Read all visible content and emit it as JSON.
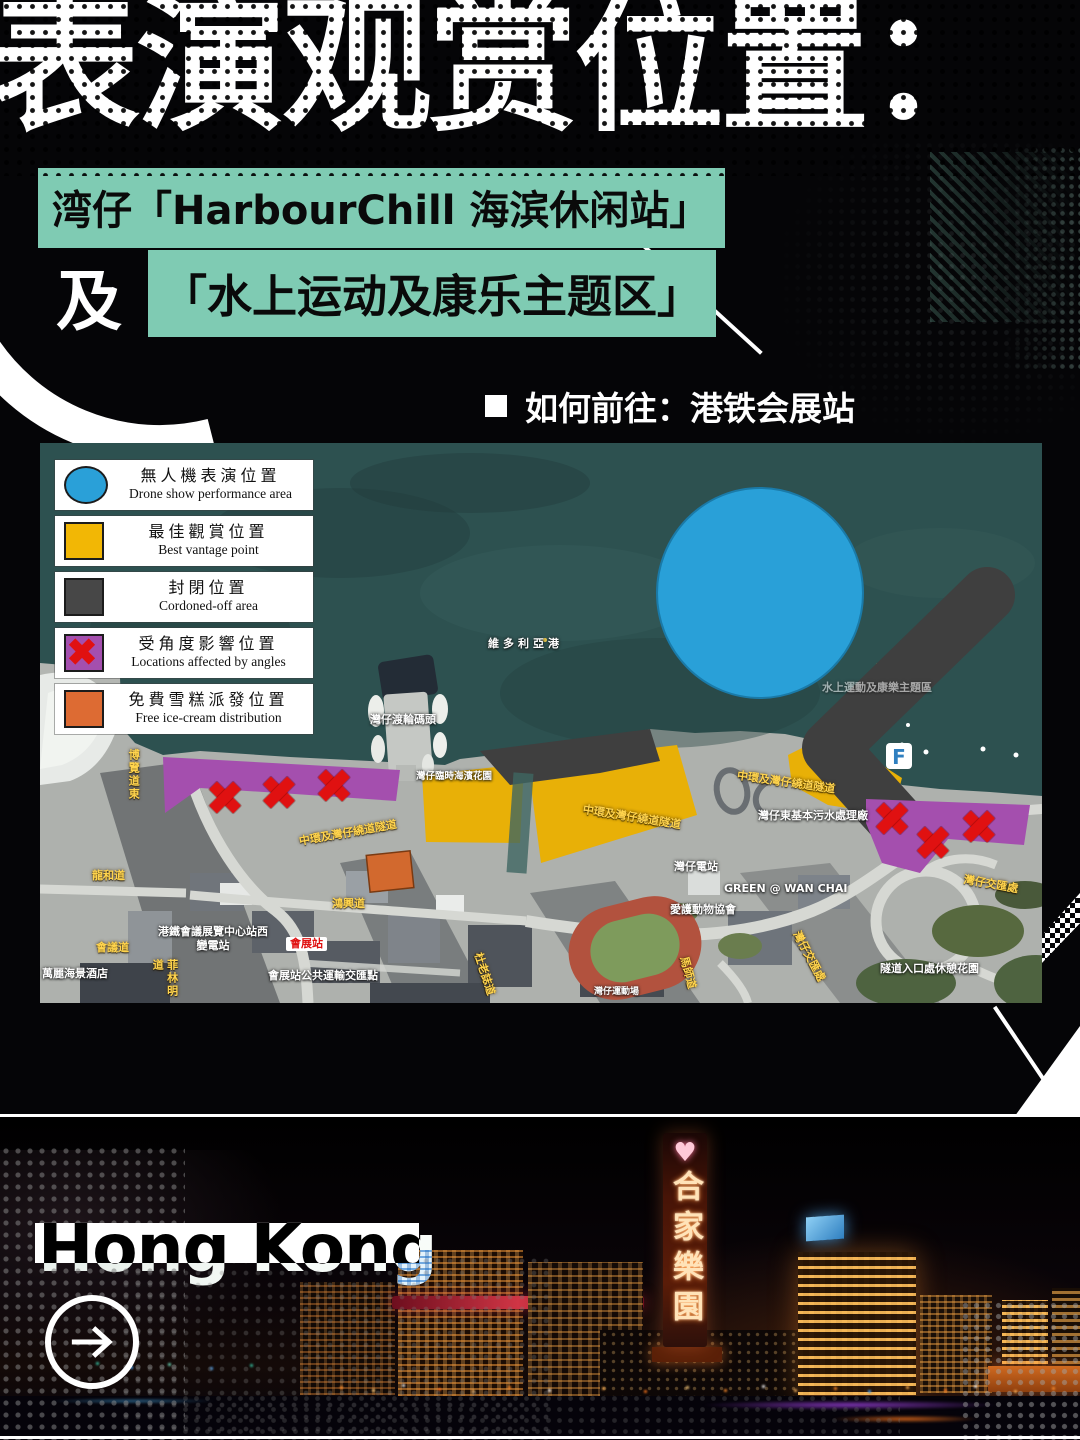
{
  "header": {
    "title": "表演观赏位置：",
    "venue_line1": "湾仔「HarbourChill 海滨休闲站」",
    "conjunction": "及",
    "venue_line2": "「水上运动及康乐主题区」",
    "directions_text": "如何前往：港铁会展站"
  },
  "colors": {
    "accent_teal": "#7fcbb3",
    "title_white": "#ffffff"
  },
  "legend": {
    "items": [
      {
        "name": "drone-show-area",
        "shape": "circle",
        "color": "#2aa0d8",
        "zh": "無人機表演位置",
        "en": "Drone show performance area"
      },
      {
        "name": "best-vantage",
        "shape": "square",
        "color": "#f2b705",
        "zh": "最佳觀賞位置",
        "en": "Best vantage point"
      },
      {
        "name": "cordoned-off",
        "shape": "square",
        "color": "#474747",
        "zh": "封閉位置",
        "en": "Cordoned-off area"
      },
      {
        "name": "affected-by-angles",
        "shape": "square-x",
        "color": "#a44fae",
        "x_color": "#e01111",
        "zh": "受角度影響位置",
        "en": "Locations affected by angles"
      },
      {
        "name": "free-ice-cream",
        "shape": "square",
        "color": "#dd6b33",
        "zh": "免費雪糕派發位置",
        "en": "Free ice-cream distribution"
      }
    ]
  },
  "map": {
    "colors": {
      "water": "#2d5150",
      "land": "#b3b6b2",
      "drone": "#29a0d8",
      "drone_edge": "#1a7aa8",
      "vantage": "#e8b007",
      "cordoned": "#3f3f3f",
      "angles": "#a44fae",
      "x_mark": "#e01111",
      "icecream": "#d2692e"
    },
    "pier_logo": "F",
    "labels": [
      {
        "text": "維多利亞港",
        "x": 448,
        "y": 194,
        "c": "white",
        "sp": 4
      },
      {
        "text": "灣仔渡輪碼頭",
        "x": 330,
        "y": 270,
        "c": "white"
      },
      {
        "text": "水上運動及康樂主題區",
        "x": 782,
        "y": 238,
        "c": "white",
        "dim": 1
      },
      {
        "text": "中環及灣仔繞道隧道",
        "x": 258,
        "y": 392,
        "c": "yellow",
        "rot": -10
      },
      {
        "text": "中環及灣仔繞道隧道",
        "x": 544,
        "y": 360,
        "c": "yellow",
        "rot": 9
      },
      {
        "text": "中環及灣仔繞道隧道",
        "x": 698,
        "y": 326,
        "c": "yellow",
        "rot": 8
      },
      {
        "text": "博覽道東",
        "x": 86,
        "y": 306,
        "c": "yellow",
        "vert": 1
      },
      {
        "text": "龍和道",
        "x": 52,
        "y": 426,
        "c": "yellow"
      },
      {
        "text": "會議道",
        "x": 56,
        "y": 498,
        "c": "yellow"
      },
      {
        "text": "菲林明道",
        "x": 110,
        "y": 516,
        "c": "yellow",
        "vert": 1
      },
      {
        "text": "港鐵會議展覽中心站西\n變電站",
        "x": 118,
        "y": 482,
        "c": "white",
        "center": 1
      },
      {
        "text": "會展站",
        "x": 246,
        "y": 494,
        "c": "red-badge"
      },
      {
        "text": "會展站公共運輸交匯點",
        "x": 228,
        "y": 526,
        "c": "white"
      },
      {
        "text": "萬麗海景酒店",
        "x": 2,
        "y": 524,
        "c": "white"
      },
      {
        "text": "鴻興道",
        "x": 292,
        "y": 454,
        "c": "yellow"
      },
      {
        "text": "灣仔東基本污水處理廠",
        "x": 718,
        "y": 366,
        "c": "white"
      },
      {
        "text": "灣仔電站",
        "x": 634,
        "y": 417,
        "c": "white"
      },
      {
        "text": "GREEN @ WAN CHAI",
        "x": 684,
        "y": 439,
        "c": "white"
      },
      {
        "text": "愛護動物協會",
        "x": 630,
        "y": 460,
        "c": "white"
      },
      {
        "text": "灣仔交匯處",
        "x": 925,
        "y": 430,
        "c": "yellow",
        "rot": 10
      },
      {
        "text": "灣仔交匯處",
        "x": 762,
        "y": 486,
        "c": "yellow",
        "rot": 62
      },
      {
        "text": "隧道入口處休憩花園",
        "x": 840,
        "y": 519,
        "c": "white"
      },
      {
        "text": "馬師道",
        "x": 650,
        "y": 512,
        "c": "yellow",
        "rot": 75
      },
      {
        "text": "杜老誌道",
        "x": 444,
        "y": 508,
        "c": "yellow",
        "rot": 72
      },
      {
        "text": "灣仔臨時海濱花園",
        "x": 376,
        "y": 328,
        "c": "white",
        "size": 9.5
      },
      {
        "text": "灣仔運動場",
        "x": 554,
        "y": 544,
        "c": "white",
        "size": 9
      }
    ],
    "x_marks": [
      [
        185,
        354
      ],
      [
        239,
        349
      ],
      [
        294,
        342
      ],
      [
        852,
        375
      ],
      [
        893,
        399
      ],
      [
        939,
        383
      ]
    ]
  },
  "footer": {
    "brand": "Hong Kong",
    "sign_heart": "♥",
    "sign_text": "合家樂園"
  }
}
